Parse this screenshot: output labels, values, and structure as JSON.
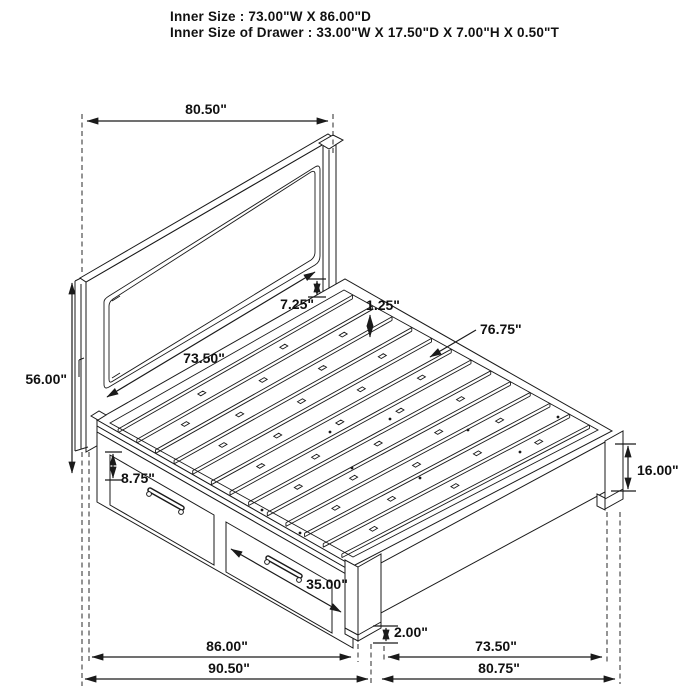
{
  "title": {
    "line1": "Inner Size : 73.00\"W X 86.00\"D",
    "line2": "Inner Size of Drawer : 33.00\"W X 17.50\"D X 7.00\"H X 0.50\"T"
  },
  "dimensions": {
    "headboard_width": "80.50\"",
    "headboard_height": "56.00\"",
    "headboard_inner_width": "73.50\"",
    "panel_to_deck_gap": "7.25\"",
    "slat_thickness": "1.25\"",
    "slat_area_length": "76.75\"",
    "footboard_height": "16.00\"",
    "rail_top_height": "8.75\"",
    "drawer_front_width": "35.00\"",
    "floor_clearance": "2.00\"",
    "base_inner_depth": "86.00\"",
    "overall_depth": "90.50\"",
    "foot_inner_width": "73.50\"",
    "foot_overall_width": "80.75\""
  },
  "colors": {
    "line": "#1a1a1a",
    "background": "#ffffff"
  }
}
